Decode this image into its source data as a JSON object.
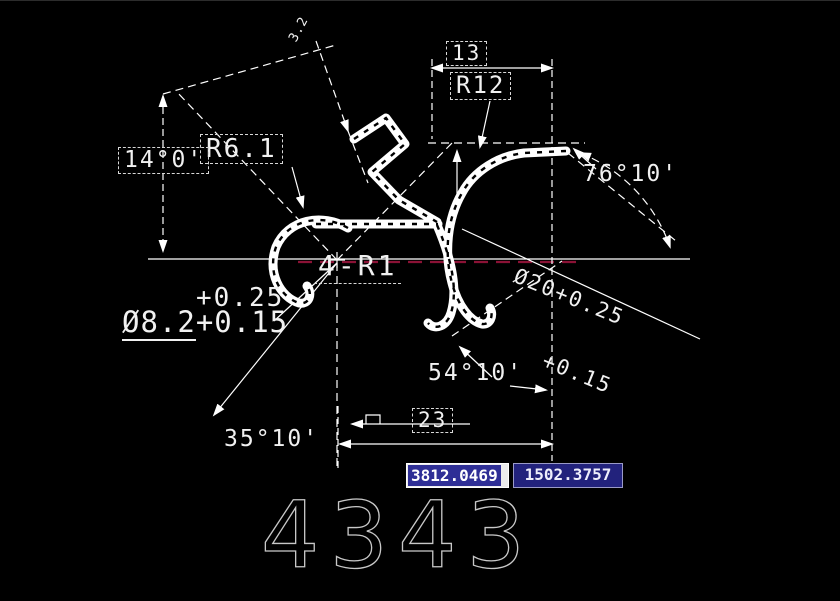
{
  "drawing": {
    "labels": {
      "top_small": "3.2",
      "dim_13": "13",
      "r12": "R12",
      "r6_1": "R6.1",
      "angle_14": "14°0'",
      "angle_76": "76°10'",
      "angle_54": "54°10'",
      "angle_35": "35°10'",
      "dim_23": "23",
      "fillets": "4-R1",
      "dia8_plus": "+0.25",
      "dia8_main": "Ø8.2",
      "dia8_minus": "+0.15",
      "dia20_line1": "Ø20+0.25",
      "dia20_line2": "+0.15"
    },
    "part_number": "4343",
    "colors": {
      "background": "#000000",
      "line_color": "#ffffff",
      "centerline_red": "#8b1236",
      "part_number_color": "#c8c8c8",
      "coord_selected_bg": "#2e2e96",
      "coord_field_bg": "#22227c"
    }
  },
  "status_bar": {
    "coord_x": "3812.0469",
    "coord_y": "1502.3757"
  }
}
